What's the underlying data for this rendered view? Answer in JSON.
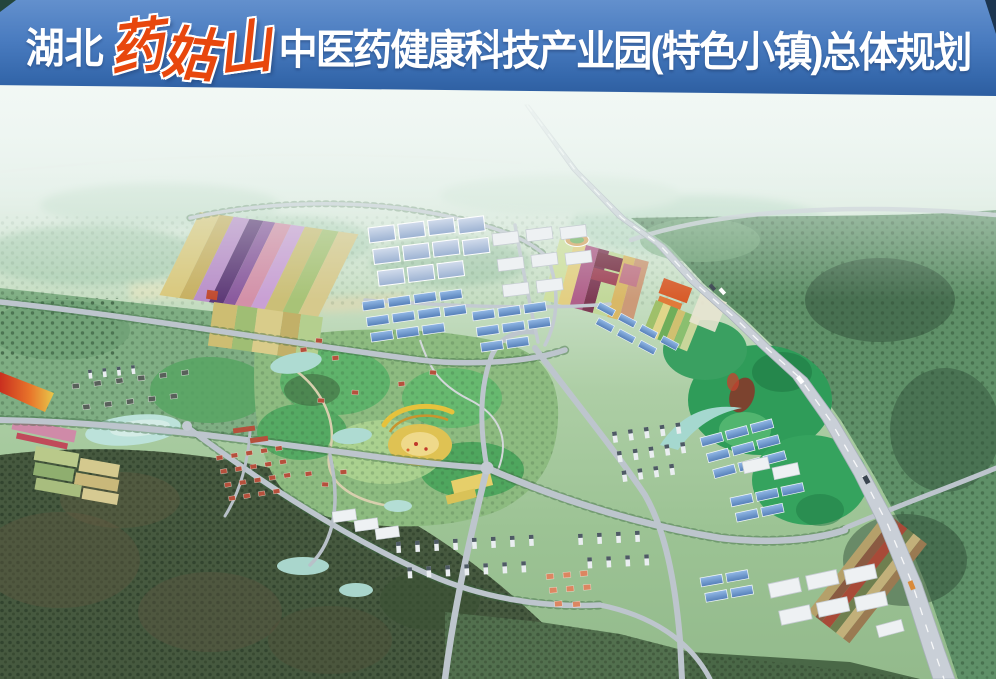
{
  "title": {
    "prefix": "湖北",
    "mountain_chars": [
      "药",
      "姑",
      "山"
    ],
    "main": "中医药健康科技产业园(特色小镇)总体规划"
  },
  "colors": {
    "banner_blue_top": "#6390cd",
    "banner_blue_bottom": "#2c5c9e",
    "mountain_name_red": "#e8470d",
    "title_white": "#ffffff",
    "highway_gray": "#c9cfd7",
    "road_gray": "#bdc5cd",
    "forest_green": "#5f9068",
    "dark_forest_green": "#46593f",
    "bright_hill_green": "#2f9c59",
    "blue_roof": "#5d8fce",
    "white_roof": "#eef1f3",
    "red_roof": "#b5503c",
    "lake_aqua": "#bce2da",
    "field_wheat": "#d9c87c",
    "field_purple": "#5e3a78",
    "field_pink": "#d390a8",
    "flower_orange": "#e8742a"
  }
}
